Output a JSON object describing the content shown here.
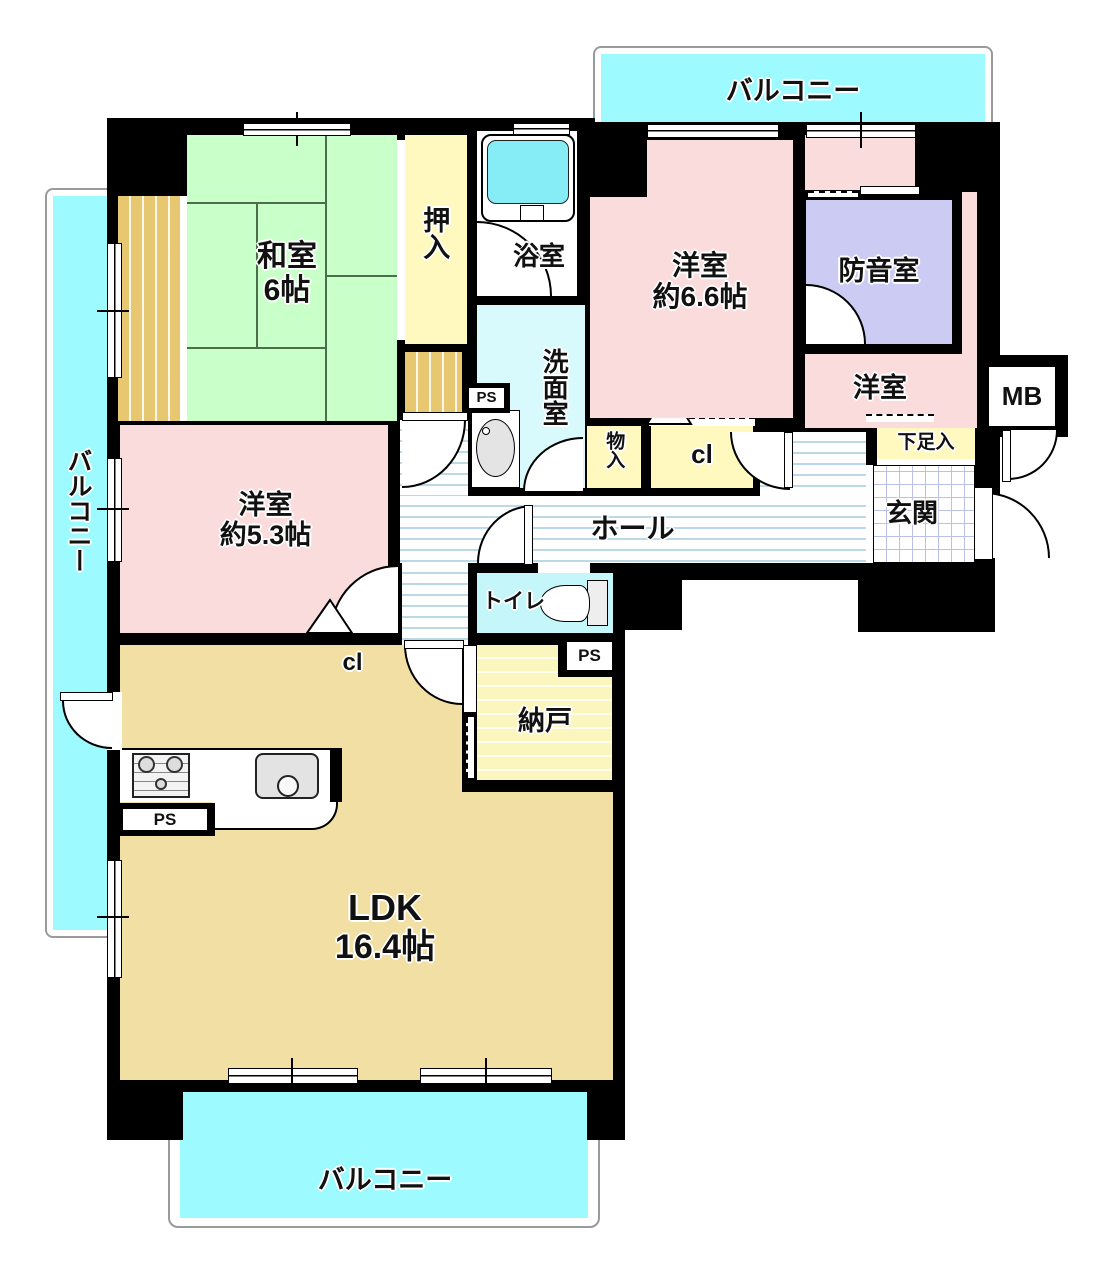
{
  "title": "マンション間取り図 (3LDK+納戸+防音室)",
  "labels": {
    "balcony": "バルコニー",
    "washitsu": "和室",
    "washitsu_size": "6帖",
    "oshiire": "押入",
    "bath": "浴室",
    "senmen": "洗面室",
    "ps": "PS",
    "monoire": "物入",
    "closet": "cl",
    "yoshitsu": "洋室",
    "yoshitsu66_size": "約6.6帖",
    "bouon": "防音室",
    "mb": "MB",
    "getabako": "下足入",
    "genkan": "玄関",
    "hall": "ホール",
    "toilet": "トイレ",
    "nando": "納戸",
    "yoshitsu53_size": "約5.3帖",
    "ldk": "LDK",
    "ldk_size": "16.4帖"
  },
  "colors": {
    "wall": "#000000",
    "balcony": "#9DFBFF",
    "tatami": "#C9FFC9",
    "wood_edge": "#E7C76F",
    "western_room": "#FBDCDC",
    "soundproof_room": "#CBCBF3",
    "ldk": "#F2DFA4",
    "closet": "#FFF9C0",
    "toilet": "#C4F6FA",
    "washroom": "#D9FAFD",
    "bathtub": "#86EDF6"
  }
}
